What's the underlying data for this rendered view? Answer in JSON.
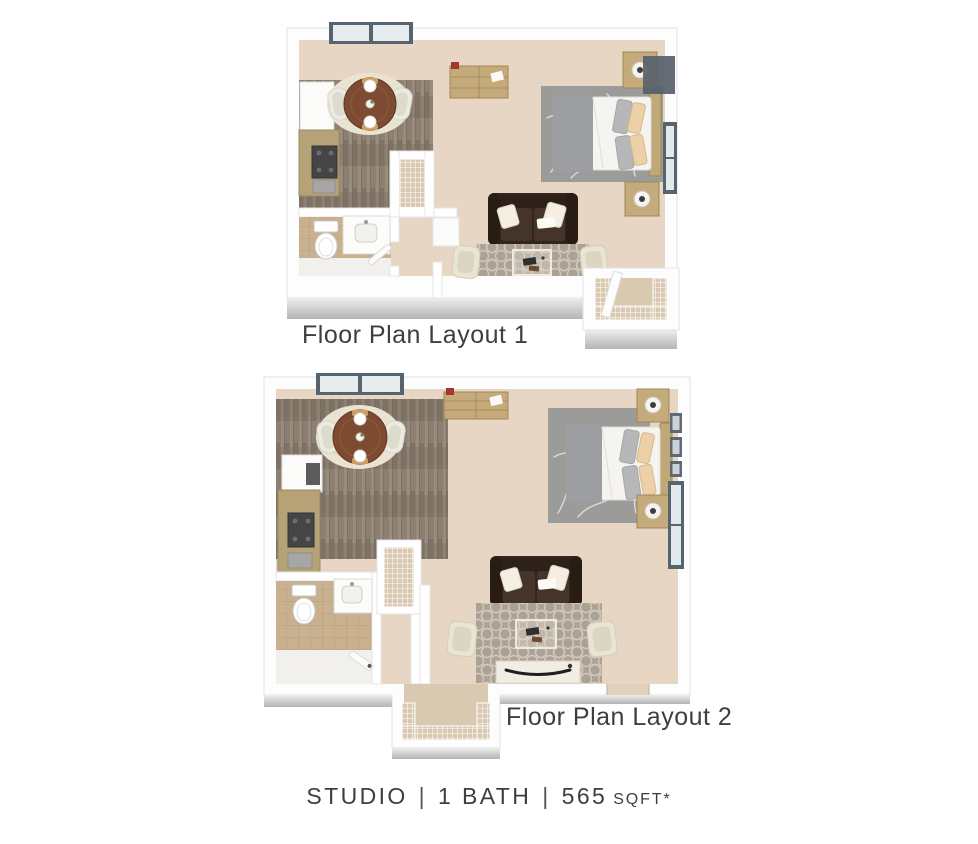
{
  "page": {
    "background": "#ffffff"
  },
  "summary": {
    "unit_type": "STUDIO",
    "divider1": "|",
    "bath": "1 BATH",
    "divider2": "|",
    "area_value": "565",
    "area_unit": "SQFT*"
  },
  "floorplans": {
    "layout1": {
      "label": "Floor Plan Layout 1",
      "rooms": [
        "open living and sleeping area",
        "kitchen",
        "dining nook",
        "bathroom",
        "hall closet",
        "entry closet"
      ],
      "furniture": [
        "double window",
        "dresser",
        "bed with gray blanket and pillows",
        "two nightstands with lamps",
        "branch-pattern area rug",
        "brown loveseat",
        "two accent chairs",
        "coffee table",
        "trellis area rug",
        "round dining table with two chairs",
        "oval dining rug",
        "kitchen counter with stove and sink",
        "refrigerator",
        "toilet",
        "vanity sink",
        "wire closet shelving",
        "window on right wall",
        "wall art"
      ]
    },
    "layout2": {
      "label": "Floor Plan Layout 2",
      "rooms": [
        "open living and sleeping area",
        "kitchen",
        "dining nook",
        "bathroom",
        "hall closet",
        "entry closet bump-out"
      ],
      "furniture": [
        "double window",
        "dresser",
        "bed with gray blanket and pillows",
        "two nightstands with lamps",
        "branch-pattern area rug",
        "brown loveseat",
        "two accent chairs",
        "coffee table",
        "media console",
        "trellis area rug",
        "round dining table with two chairs",
        "oval dining rug",
        "kitchen counter with stove and sink",
        "refrigerator",
        "toilet",
        "vanity sink",
        "wire closet shelving",
        "window on right wall",
        "picture frames"
      ]
    }
  },
  "colors": {
    "carpet": "#e7d6c3",
    "wood_floor": "#8d8072",
    "tile_floor": "#c9b08f",
    "cabinetry": "#b5a277",
    "sofa": "#33251c",
    "bed_rug": "#9b9b99",
    "trellis_rug": "#aca195",
    "dining_table": "#7c4b31",
    "window_frame": "#56646f",
    "accent_pillow": "#ecd0a8",
    "wall": "#ffffff",
    "shadow": "#b4b4b4",
    "text": "#3e3e3e"
  }
}
